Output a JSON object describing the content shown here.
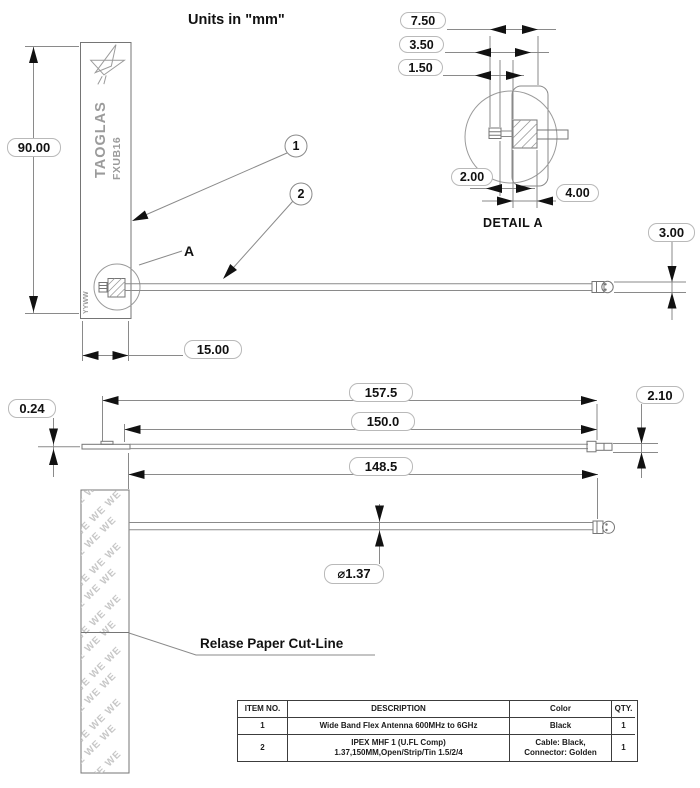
{
  "title": "Units in \"mm\"",
  "front_view": {
    "brand": "TAOGLAS",
    "model": "FXUB16",
    "date_code": "YYWW",
    "balloon_1": "1",
    "balloon_2": "2",
    "detail_ref": "A",
    "dim_height": "90.00",
    "dim_width": "15.00",
    "dim_connector_od": "3.00"
  },
  "detail_a": {
    "title": "DETAIL A",
    "dim_pad_span": "7.50",
    "dim_pad_offset": "3.50",
    "dim_pin_width": "1.50",
    "dim_pin_gap": "2.00",
    "dim_pad_width": "4.00"
  },
  "side_view": {
    "dim_thickness": "0.24",
    "dim_overall_length": "157.5",
    "dim_cable_length": "150.0",
    "dim_connector_height": "2.10"
  },
  "bottom_view": {
    "dim_cut_to_connector": "148.5",
    "dim_cable_diameter": "⌀1.37",
    "note": "Relase Paper Cut-Line",
    "pattern_text": "WE WE WE"
  },
  "bom_table": {
    "headers": [
      "ITEM NO.",
      "DESCRIPTION",
      "Color",
      "QTY."
    ],
    "rows": [
      {
        "item_no": "1",
        "description_line1": "Wide Band Flex Antenna 600MHz to 6GHz",
        "description_line2": "",
        "color_line1": "Black",
        "color_line2": "",
        "qty": "1"
      },
      {
        "item_no": "2",
        "description_line1": "IPEX MHF 1 (U.FL Comp)",
        "description_line2": "1.37,150MM,Open/Strip/Tin 1.5/2/4",
        "color_line1": "Cable: Black,",
        "color_line2": "Connector: Golden",
        "qty": "1"
      }
    ]
  }
}
